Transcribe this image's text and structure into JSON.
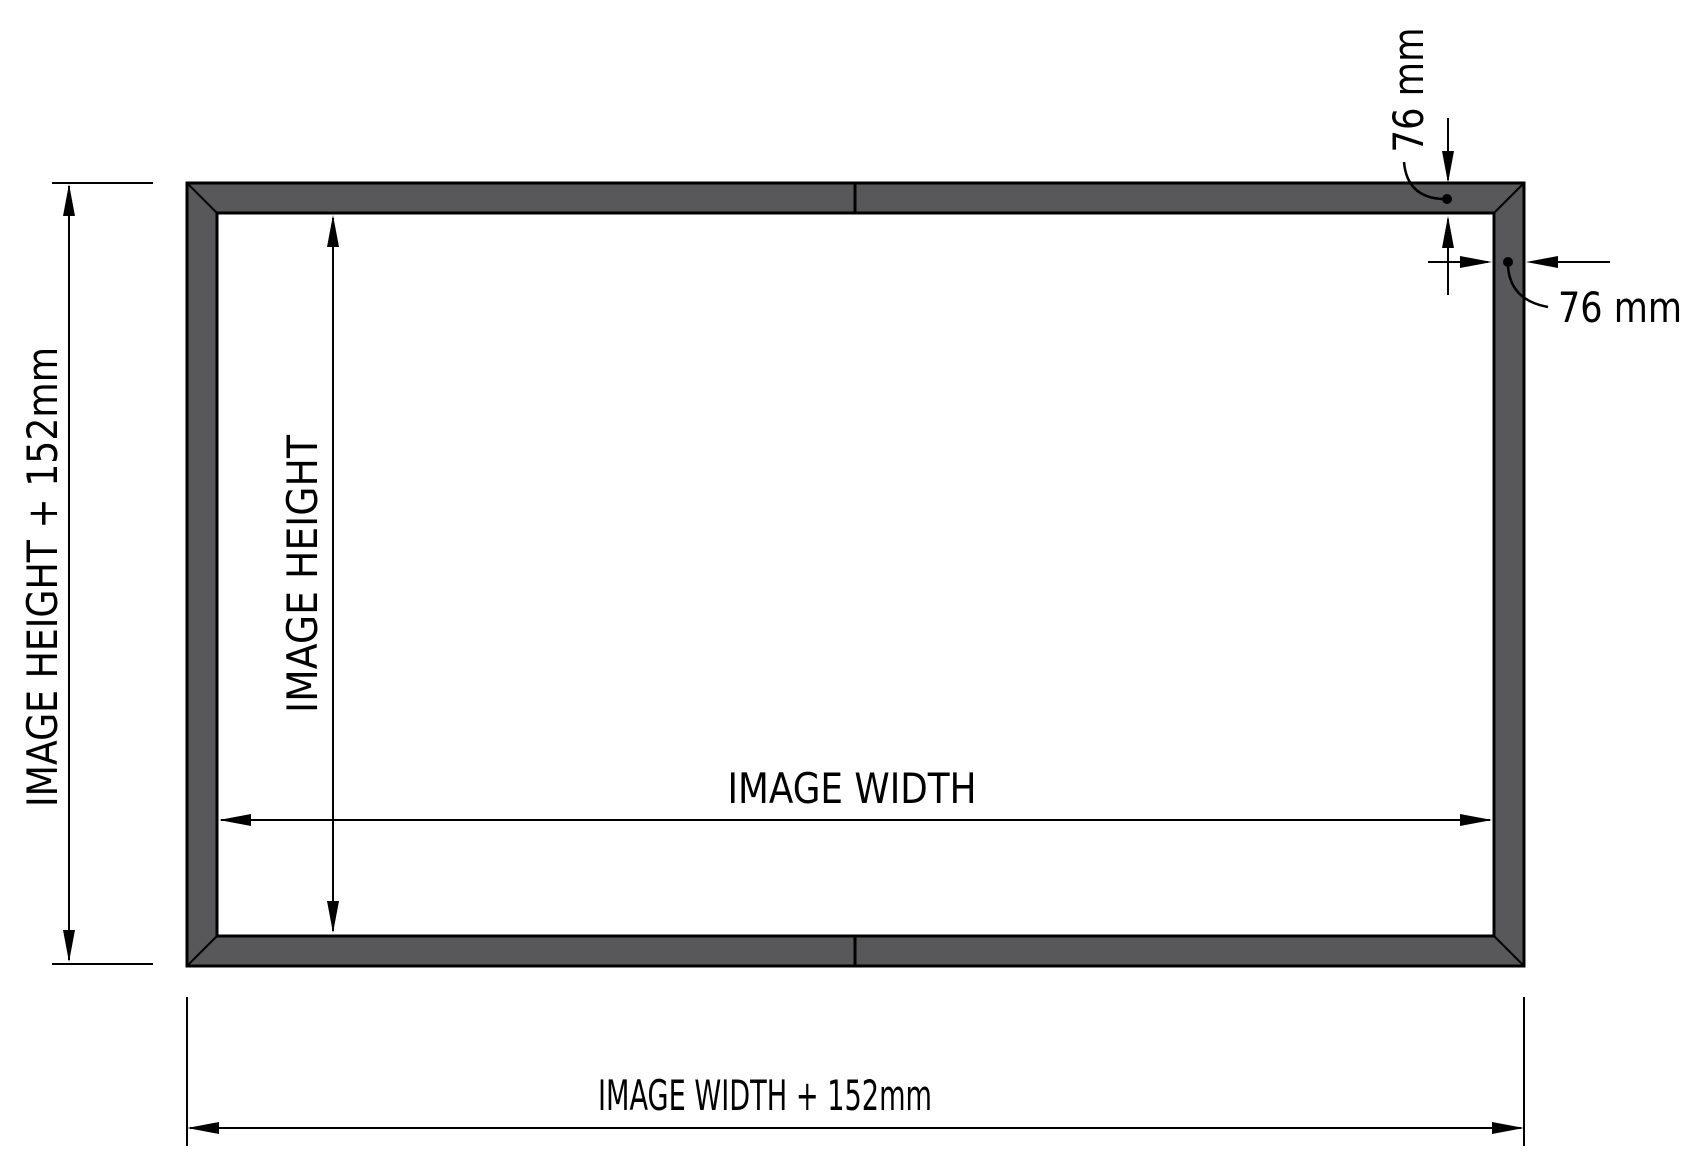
{
  "diagram": {
    "type": "technical-drawing",
    "subject": "picture-frame outer and inner dimension diagram",
    "colors": {
      "background": "#ffffff",
      "frame_fill": "#58585a",
      "line": "#000000"
    },
    "labels": {
      "outer_height": "IMAGE HEIGHT + 152mm",
      "inner_height": "IMAGE HEIGHT",
      "image_width": "IMAGE WIDTH",
      "outer_width": "IMAGE WIDTH + 152mm",
      "top_bar_thickness": "76 mm",
      "side_bar_thickness": "76 mm"
    }
  }
}
